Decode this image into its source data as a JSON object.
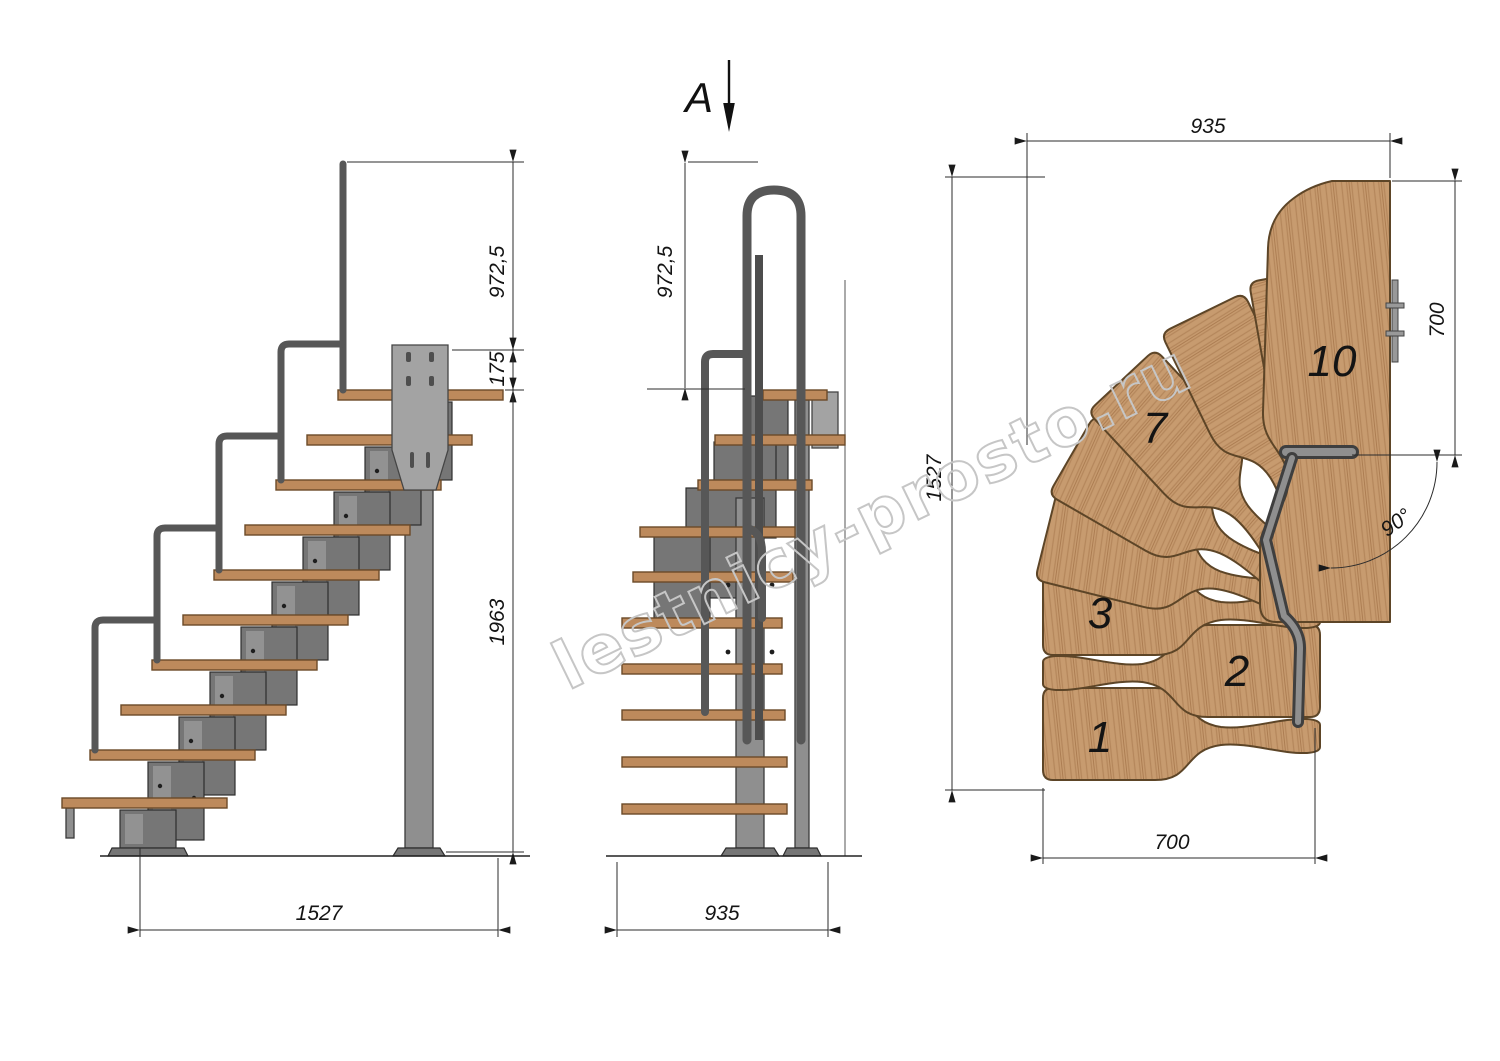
{
  "drawing": {
    "watermark": "lestnicy-prosto.ru",
    "section_label": "A",
    "side_view": {
      "dim_rail_height": "972,5",
      "dim_plate_rise": "175",
      "dim_column_height": "1963",
      "dim_run": "1527"
    },
    "front_view": {
      "dim_rail_height": "972,5",
      "dim_width": "935"
    },
    "plan_view": {
      "dim_top_width": "935",
      "dim_left_length": "1527",
      "dim_landing_depth": "700",
      "dim_flight_width": "700",
      "dim_turn_angle": "90°",
      "step_numbers": {
        "n1": "1",
        "n2": "2",
        "n3": "3",
        "n7": "7",
        "n10": "10"
      }
    },
    "colors": {
      "wood": "#c79b6f",
      "wood_grain": "#b5875c",
      "steel": "#8f8f8f",
      "steel_dark": "#575757",
      "line": "#2b2b2b",
      "watermark": "#c6c6c6"
    }
  }
}
